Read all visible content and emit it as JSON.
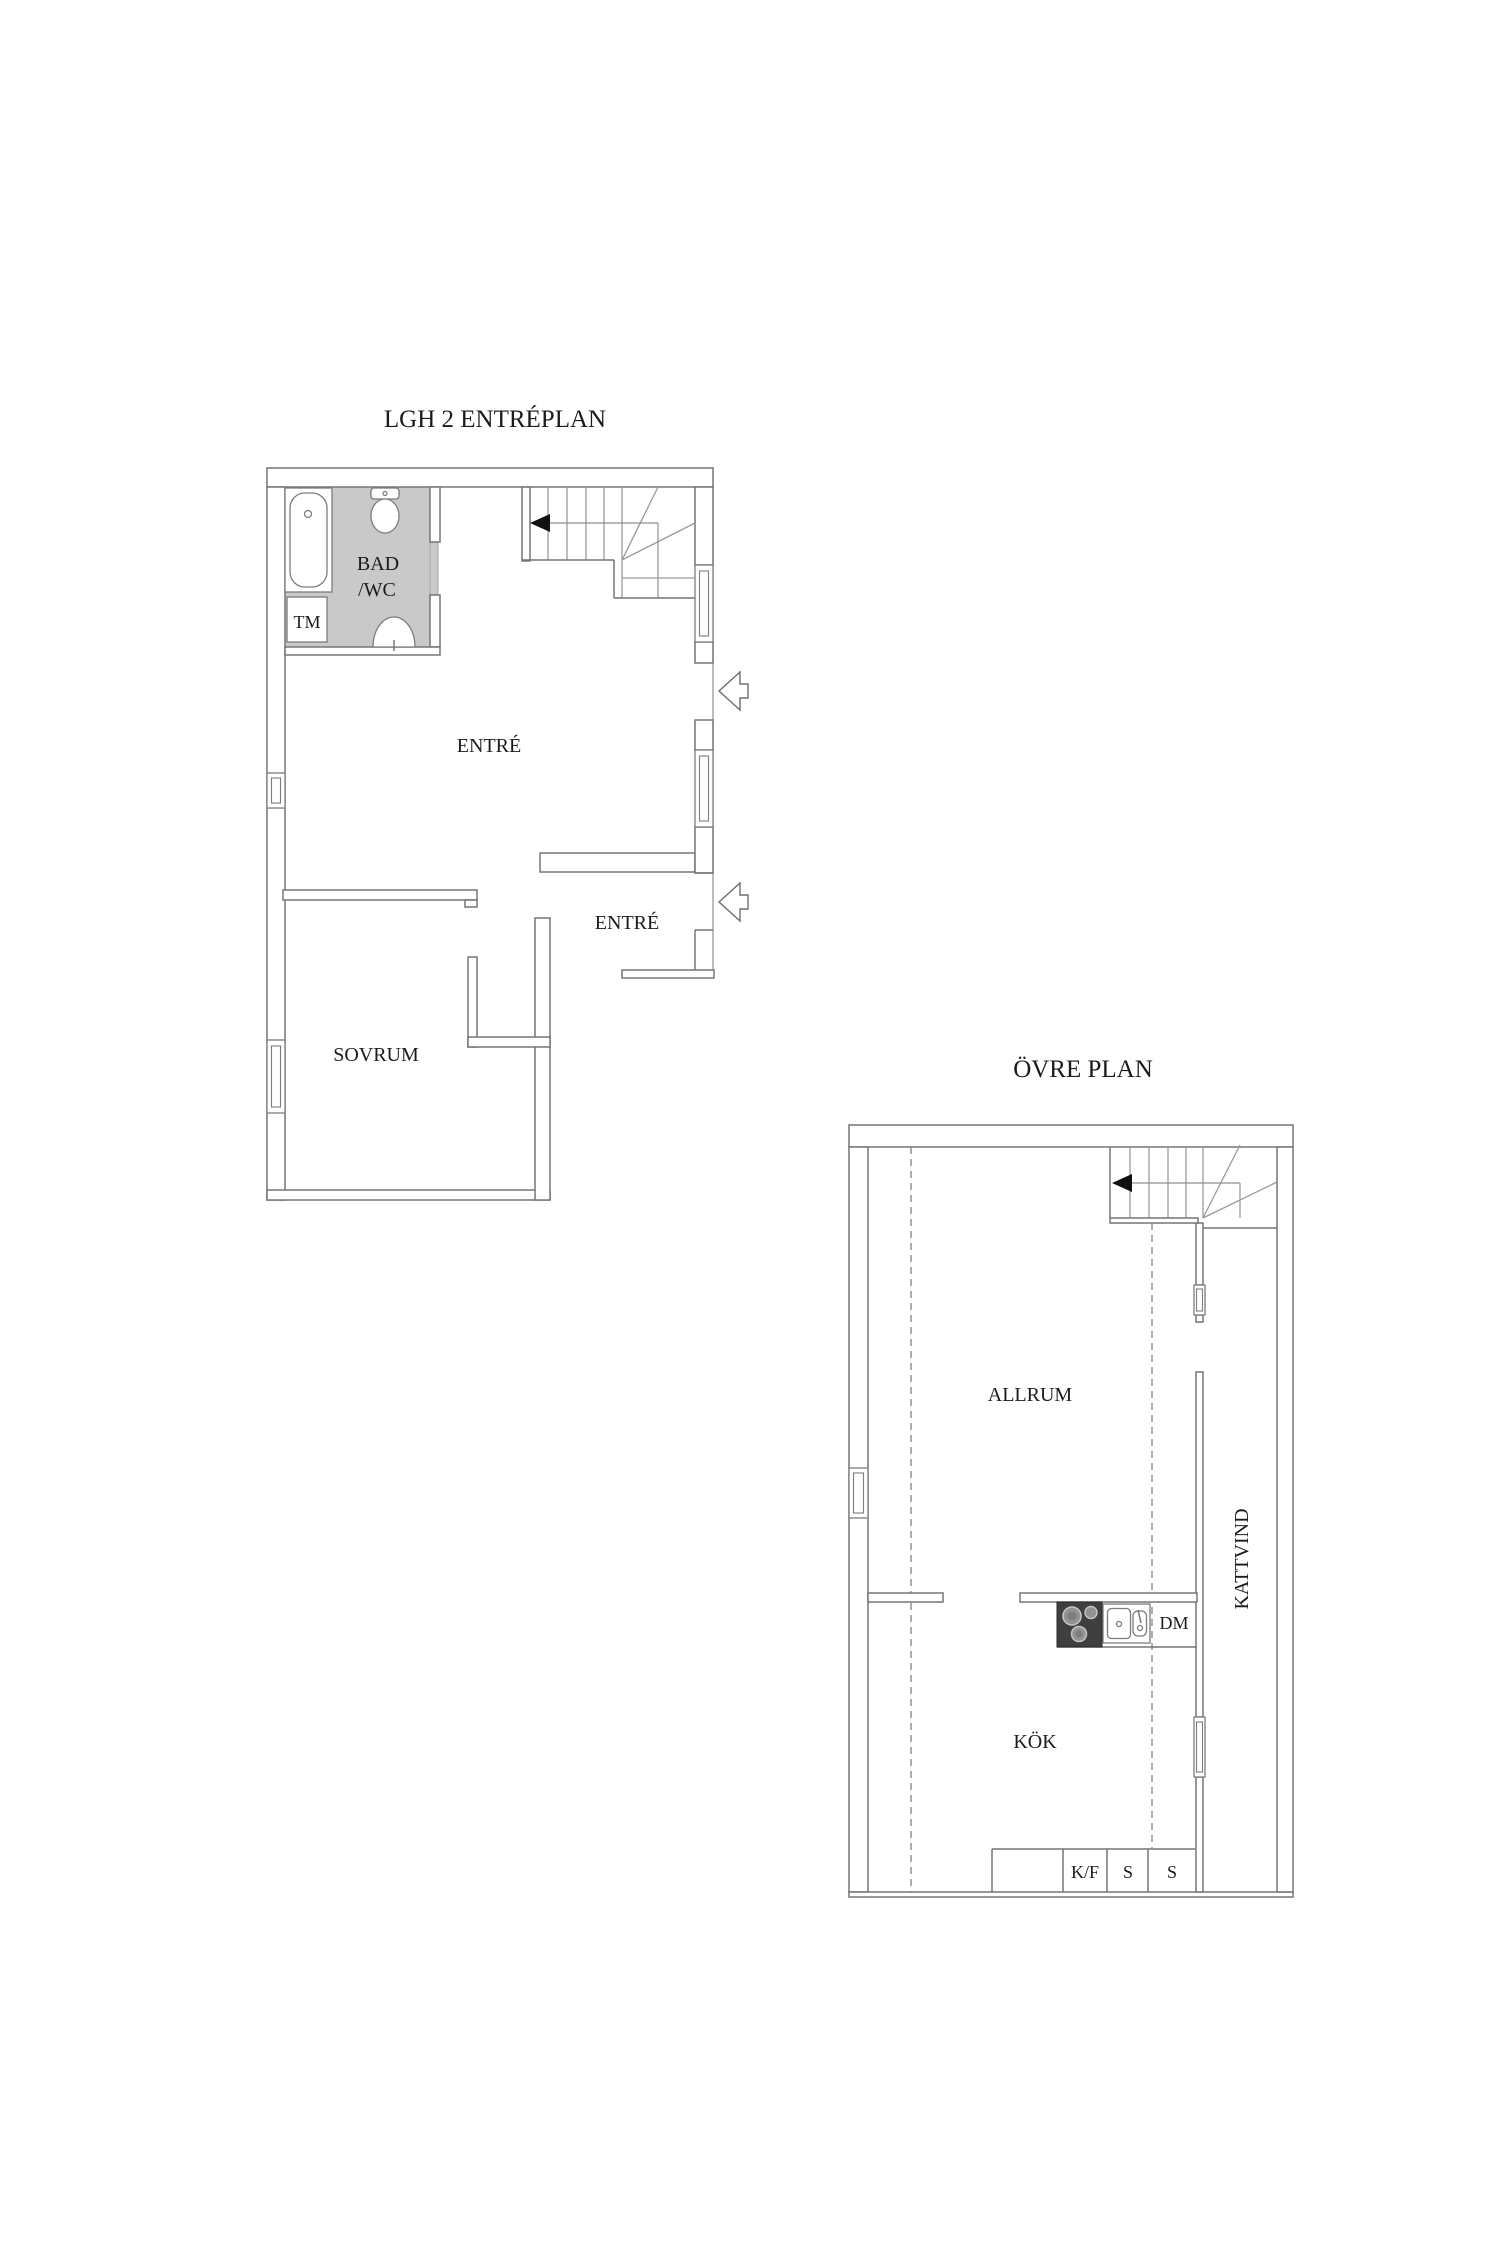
{
  "document": {
    "type": "floor-plan-drawing",
    "background": "#ffffff"
  },
  "colors": {
    "line": "#757575",
    "bathroom_fill": "#c9c9c9",
    "stove_fill": "#3f3f3f",
    "burner_fill": "#929292",
    "text": "#1b1b1b",
    "direction_arrow": "#111111"
  },
  "floor1": {
    "title": "LGH 2 ENTRÉPLAN",
    "labels": {
      "bad": "BAD",
      "wc": "/WC",
      "tm": "TM",
      "entre": "ENTRÉ",
      "entre2": "ENTRÉ",
      "sovrum": "SOVRUM"
    }
  },
  "floor2": {
    "title": "ÖVRE PLAN",
    "labels": {
      "allrum": "ALLRUM",
      "kok": "KÖK",
      "dm": "DM",
      "kattvind": "KATTVIND",
      "kf": "K/F",
      "s1": "S",
      "s2": "S"
    }
  }
}
